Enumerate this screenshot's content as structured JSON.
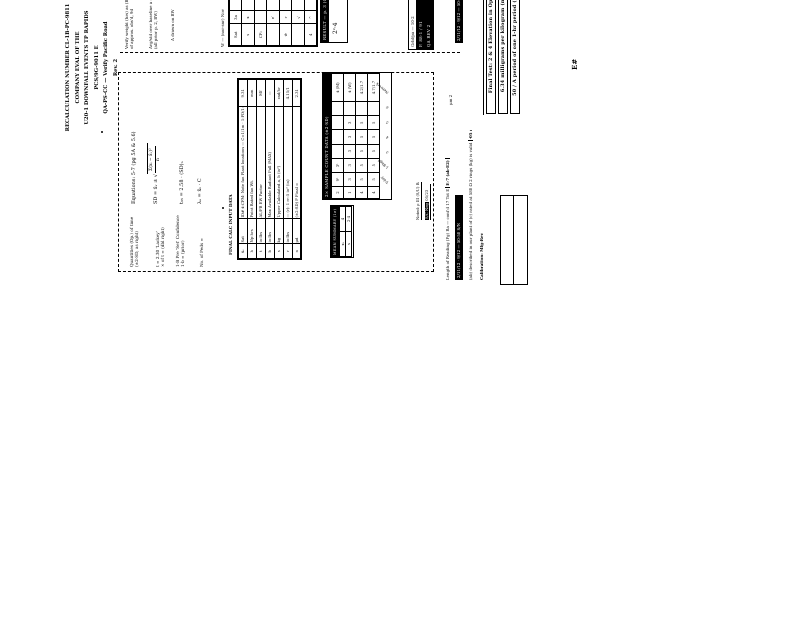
{
  "title_lines": [
    "RECALCULATION NUMBER CL-1B-PC-9811 COMPANY EVAL OF THE",
    "U20-1 DOWNFALL EVENTS TP RAPIDS PCS/9G-9011 E",
    "QA-PS-CC — Verify Pacific Road",
    "Rev. 2"
  ],
  "right_column": {
    "notes": {
      "n1": [
        "Verify weight (hrs) as (BW)",
        "of approx. obs'd, 9d"
      ],
      "n2": [
        "Avg/std over baseline a =",
        "(all prior p. 2, BW)"
      ],
      "n3": [
        "A drawn on BW"
      ],
      "n4": [
        "W — (nor-snr) Nov"
      ]
    },
    "table_a_rows": [
      [
        "Sat",
        "3a",
        "ȧ"
      ],
      [
        "s",
        "x",
        "4⁵"
      ],
      [
        "CF₂",
        "",
        "+5"
      ],
      [
        "",
        "e′",
        "ṡ"
      ],
      [
        "w̄",
        "r",
        "−"
      ],
      [
        "",
        "√",
        "4"
      ],
      [
        "4",
        "^",
        "+"
      ]
    ],
    "totals_box": {
      "header": "RESULT — p. 3 (C/S)",
      "value": "2ᶜ·4"
    },
    "analysis_block": {
      "row1": "Grbl/pa — 10·2",
      "row2": "P. 88-1 / 91",
      "row3": "QA REV 2"
    },
    "side_bar": "2/11/12 · 9/12 — 50-50 S/N"
  },
  "main_box": {
    "labels": {
      "l1": [
        "Quantities (Op.) of time",
        "(±2-SD, as right)"
      ],
      "l2": [
        "t = 2.30 'Lackey'",
        "× of t = (dbl right)"
      ],
      "l3": [
        "1-B Pre 'Set' Confidence",
        "1·b = (prior)"
      ],
      "l4": [
        "No. of Peds ="
      ]
    },
    "equations": {
      "header": "Equations: 5-7 (pg 5A & 5.6)",
      "eq1_lhs": "SD = x̄ᵥ ±",
      "eq1_num": "Σ(xᵢ − x̄ᵥ)²",
      "eq1_den": "n",
      "eq2": "t₉₅ = 2.58 · (SD)ₙ",
      "eq3": "λₐ = x̄ᵥ · C"
    },
    "input_table": {
      "title": "FINAL CALC INPUT DATA",
      "rows": [
        [
          "x̄ᵥ",
          "Sat",
          "ID# x̄-CFM: Note fan Plant locations — C=1/1m · 1-PD/1-9G",
          "9.31"
        ],
        [
          "h",
          "Np-hrs",
          "Point Rated fan Wt.",
          "mm"
        ],
        [
          "t",
          "in-lbs",
          "AL/FB EW Factor",
          "Mf"
        ],
        [
          "b",
          "in-lbs",
          "Max Available Radiant Pull (MAX)",
          "—"
        ],
        [
          "s",
          "kg",
          "Upper Calculated a, b (in²)",
          "rad/hr"
        ],
        [
          "r",
          "in-lbs",
          "— (r): 1 rr–5 in² (in)",
          "4.15/1"
        ],
        [
          "n",
          "μd",
          "(±2-SD) F Final =",
          "2.31"
        ]
      ]
    },
    "sample_table": {
      "header": "2× SAMPLE COUNT DATA (±2·SD)",
      "rows": [
        [
          "2",
          "9¹",
          "3¹",
          "",
          "",
          "",
          "",
          "x̄ (M)"
        ],
        [
          "1",
          "3",
          "3",
          "3",
          "3",
          "3",
          "",
          "x̄ (W)"
        ],
        [
          "4",
          "5",
          "5",
          "5",
          "5",
          "5",
          "",
          "4.2/1.7"
        ],
        [
          "4",
          "5",
          "5",
          "5",
          "5",
          "5",
          "",
          "4.7/1.7"
        ]
      ],
      "footer_labels": [
        "T-day",
        "1-Bkgd",
        "3",
        "4",
        "5",
        "6",
        "Network"
      ]
    },
    "summary_box": {
      "header": "MEAN SUMMARY (1σ)",
      "rows": [
        [
          "xᵢ",
          "4"
        ],
        [
          "s",
          "2·4"
        ]
      ]
    },
    "prep_line_1": "Noted: ρ III (S/U) Baseline",
    "prep_line_2_badge": "S/C Neg",
    "prep_line_2_text": " 05/23"
  },
  "footer": {
    "f1_text": "Length of Reading (Pg) Ra — cont'd 17 Tot E ",
    "f1_badge": "E-7 (ab·E2)",
    "f2_bar": "2/11/12 · 9/12 — 50-50 S/N",
    "f3_text": "(ab) described in our plant of (c) rated at 580 Ω 2 rings (kg) is valid ",
    "f3_badge": "·05 mg/L",
    "f4_text": "Calibration: Mfg-Rev",
    "f5_text": "μm 2"
  },
  "bottom_strip": {
    "statements": [
      "Final Test: 2 & 4 Elevation in Opposite",
      "6.34 milligrams per kilogram (mg/kg)",
      "50 / A period of one 1-hr period (In/Out)"
    ]
  },
  "stray_mark": "E#"
}
